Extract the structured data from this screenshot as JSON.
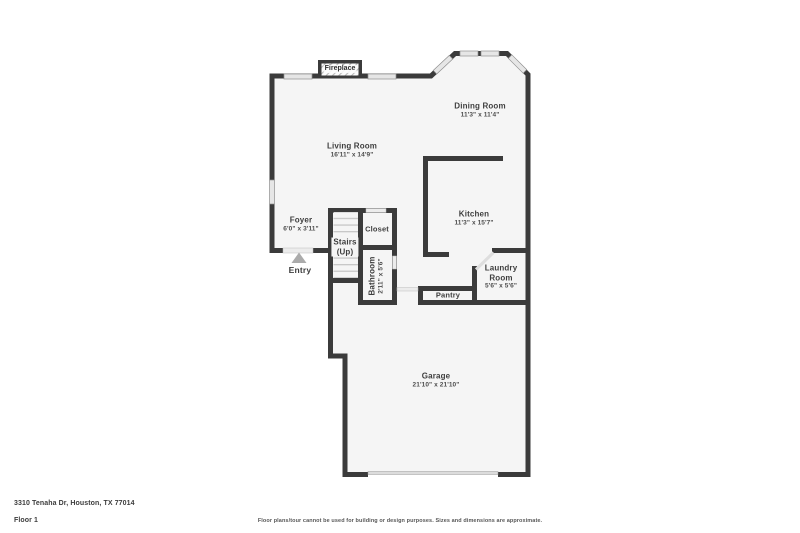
{
  "plan": {
    "fireplace_label": "Fireplace",
    "entry_label": "Entry",
    "rooms": {
      "living_room": {
        "name": "Living Room",
        "dims": "16'11\" x 14'9\""
      },
      "dining_room": {
        "name": "Dining Room",
        "dims": "11'3\" x 11'4\""
      },
      "kitchen": {
        "name": "Kitchen",
        "dims": "11'3\" x 15'7\""
      },
      "foyer": {
        "name": "Foyer",
        "dims": "6'0\" x 3'11\""
      },
      "stairs": {
        "name": "Stairs",
        "sub": "(Up)"
      },
      "closet": {
        "name": "Closet"
      },
      "bathroom": {
        "name": "Bathroom",
        "dims": "2'11\" x 5'6\""
      },
      "laundry": {
        "name": "Laundry Room",
        "dims": "5'6\" x 5'6\""
      },
      "pantry": {
        "name": "Pantry"
      },
      "garage": {
        "name": "Garage",
        "dims": "21'10\" x 21'10\""
      }
    },
    "colors": {
      "wall": "#3b3b3b",
      "floor": "#f5f5f5",
      "window": "#e6e6e6",
      "door_opening": "#ececec",
      "label_text": "#3e3e3e"
    }
  },
  "footer": {
    "address": "3310 Tenaha Dr, Houston, TX 77014",
    "floor_label": "Floor 1",
    "disclaimer": "Floor plans/tour cannot be used for building or design purposes. Sizes and dimensions are approximate."
  }
}
